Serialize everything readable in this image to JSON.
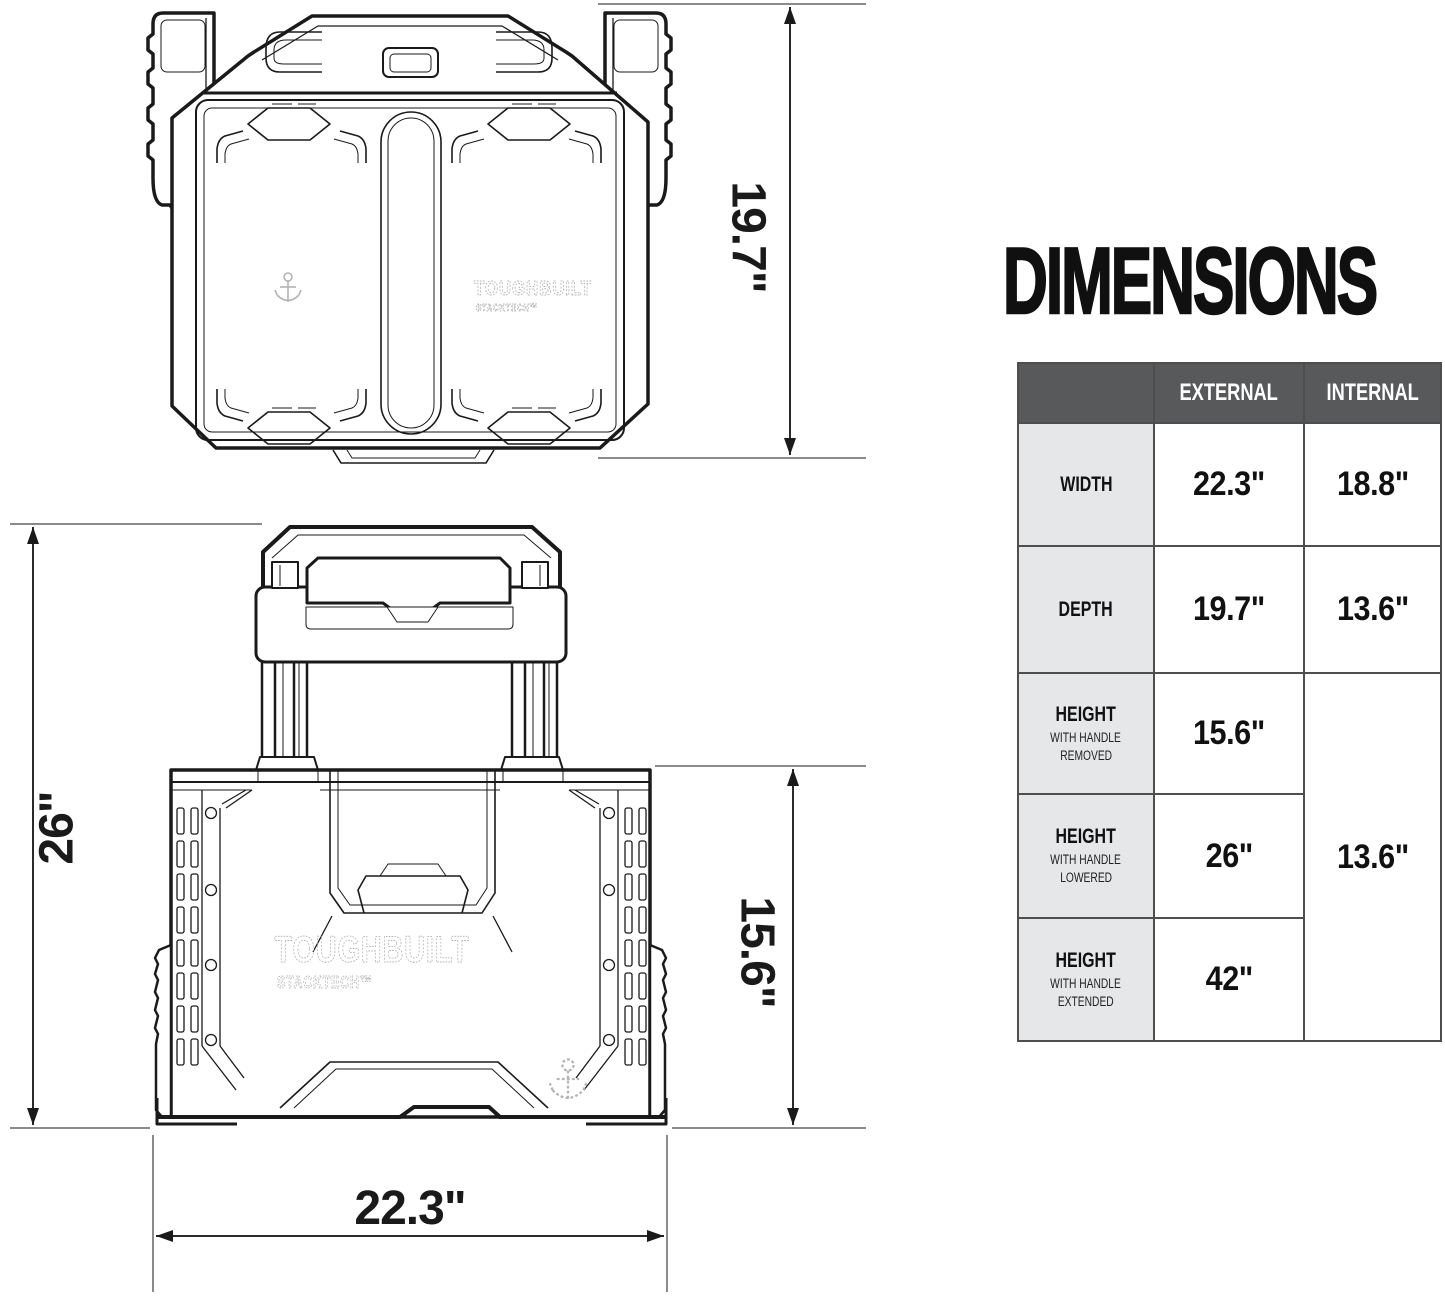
{
  "title": "DIMENSIONS",
  "brand": {
    "logo": "TOUGHBUILT",
    "logo_sub": "STACKTECH™"
  },
  "icons": {
    "anchor": "anchor-icon"
  },
  "dimension_labels": {
    "top_view_depth": "19.7\"",
    "front_total_height": "26\"",
    "front_box_height": "15.6\"",
    "front_width": "22.3\""
  },
  "table": {
    "col_headers": [
      "EXTERNAL",
      "INTERNAL"
    ],
    "rows": [
      {
        "label": "WIDTH",
        "sub1": "",
        "sub2": "",
        "external": "22.3\"",
        "internal": "18.8\""
      },
      {
        "label": "DEPTH",
        "sub1": "",
        "sub2": "",
        "external": "19.7\"",
        "internal": "13.6\""
      },
      {
        "label": "HEIGHT",
        "sub1": "WITH HANDLE",
        "sub2": "REMOVED",
        "external": "15.6\""
      },
      {
        "label": "HEIGHT",
        "sub1": "WITH HANDLE",
        "sub2": "LOWERED",
        "external": "26\"",
        "internal_merged": "13.6\""
      },
      {
        "label": "HEIGHT",
        "sub1": "WITH HANDLE",
        "sub2": "EXTENDED",
        "external": "42\""
      }
    ]
  },
  "colors": {
    "header_bg": "#58595B",
    "row_label_bg": "#E6E7E8",
    "table_border": "#4D4E50",
    "ink": "#1A1A1A",
    "extension_line": "#8A8A8A",
    "faint_logo": "#B3B3B3"
  }
}
